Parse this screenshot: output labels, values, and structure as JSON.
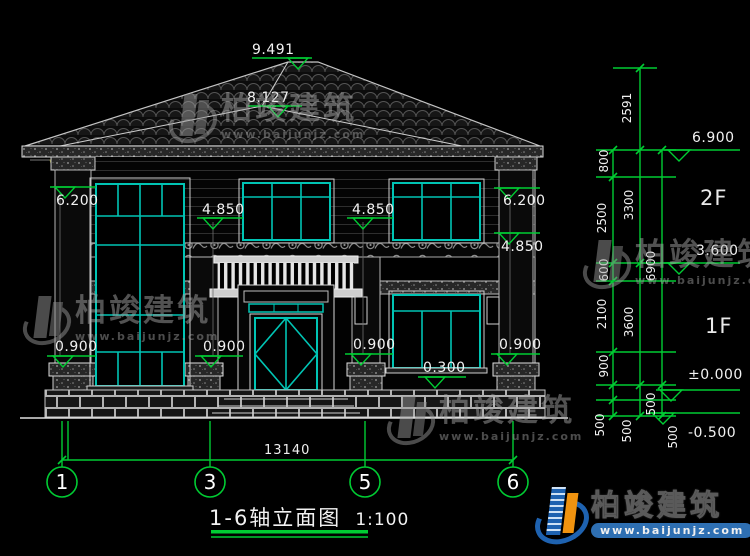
{
  "title": {
    "text": "1-6轴立面图",
    "scale": "1:100"
  },
  "brand": {
    "name": "柏竣建筑",
    "url": "www.baijunjz.com"
  },
  "marks": {
    "ridge": "9.491",
    "sub_ridge": "8.127",
    "eave_left": "6.200",
    "eave_right": "6.200",
    "lintel_2f_a": "4.850",
    "lintel_2f_b": "4.850",
    "lintel_2f_c": "4.850",
    "sill_a": "0.900",
    "sill_b": "0.900",
    "sill_c": "0.900",
    "sill_d": "0.900",
    "porch": "0.300",
    "roof_level": "6.900",
    "floor2_level": "3.600",
    "ground_level": "±0.000",
    "site_level": "-0.500"
  },
  "floors": {
    "f2": "2F",
    "f1": "1F"
  },
  "dims": {
    "overall": "13140",
    "above_eave": "2591",
    "a1": "800",
    "a2": "2500",
    "a3": "600",
    "a4": "2100",
    "a5": "900",
    "a6": "500",
    "a7": "500",
    "b1": "3300",
    "b2": "3600",
    "b3": "500",
    "c1": "6900",
    "c2": "500"
  },
  "axes": {
    "n1": "1",
    "n3": "3",
    "n5": "5",
    "n6": "6"
  },
  "colors": {
    "dim_green": "#00cc33",
    "frame_teal": "#00c4b4",
    "bracket_yellow": "#d6d63a",
    "logo_blue": "#1e62b0",
    "logo_orange": "#f0930f"
  }
}
